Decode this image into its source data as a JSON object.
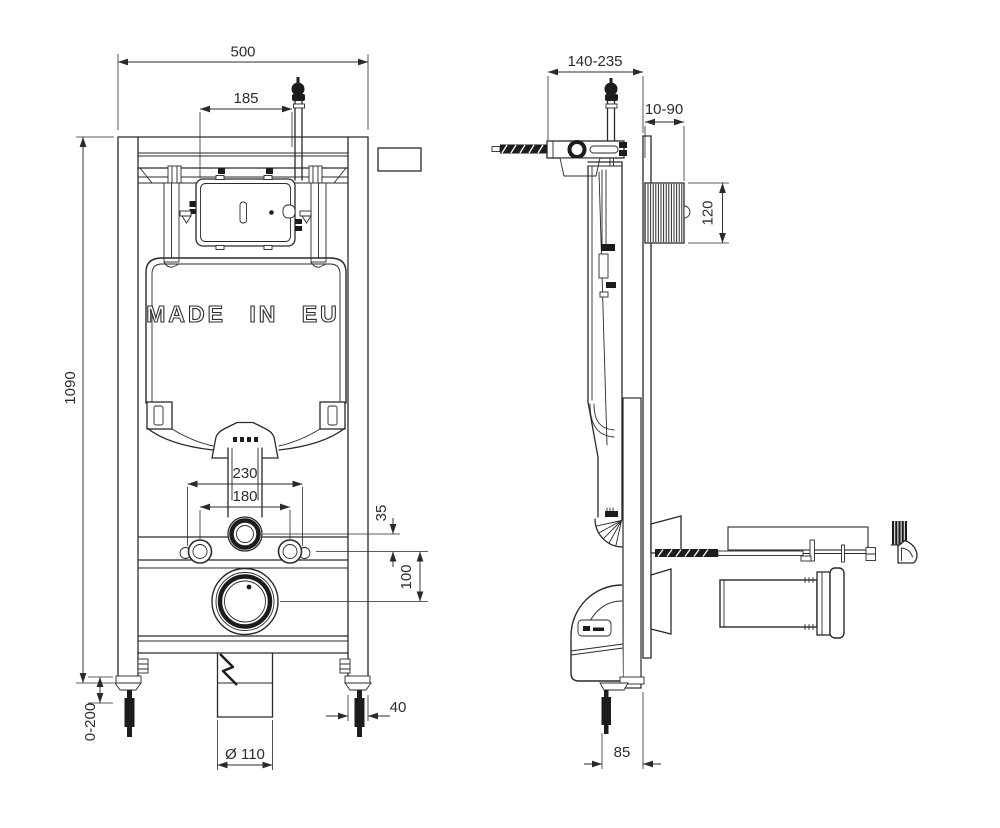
{
  "tank_label": "MADE IN EU",
  "dims": {
    "front_width": "500",
    "valve_offset": "185",
    "front_height": "1090",
    "fixing_outer": "230",
    "fixing_inner": "180",
    "pipe_to_fixings": "35",
    "fixings_to_outlet": "100",
    "leg_adjust": "0-200",
    "post_width": "40",
    "outlet_diameter": "Ø 110",
    "depth_range": "140-235",
    "wall_thickness_range": "10-90",
    "access_box_height": "120",
    "foot_to_wall": "85"
  },
  "colors": {
    "line": "#2a2a2a",
    "dark_fill": "#1c1c1c",
    "text": "#2c2c2c",
    "background": "#ffffff"
  }
}
